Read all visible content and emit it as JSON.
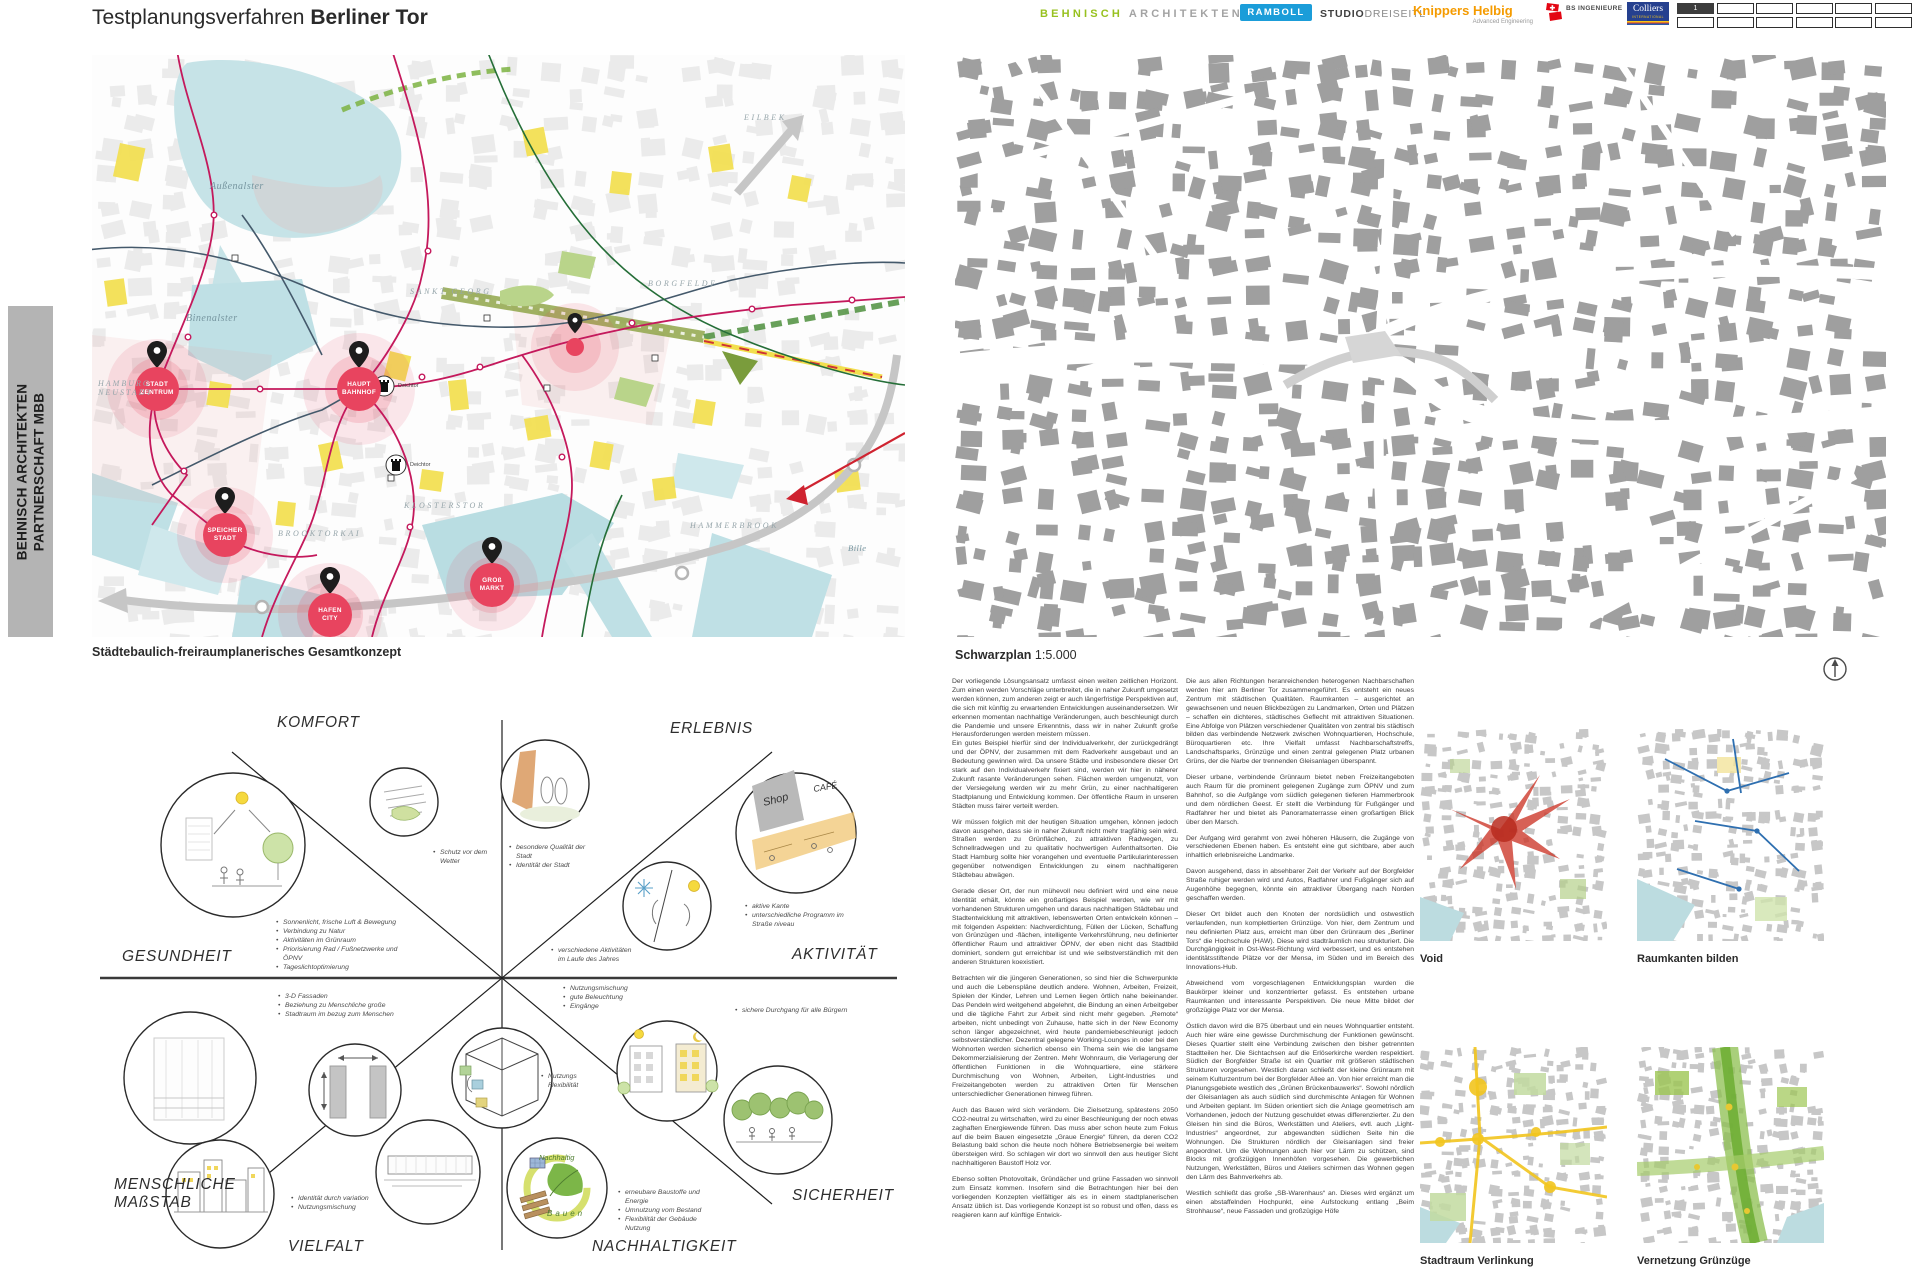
{
  "header": {
    "title_prefix": "Testplanungsverfahren",
    "title_bold": "Berliner Tor",
    "logos": {
      "behnisch_first": "BEHNISCH",
      "behnisch_second": "ARCHITEKTEN",
      "ramboll": "RAMBOLL",
      "studio_bold": "STUDIO",
      "studio_light": "DREISEITL",
      "knippers": "Knippers Helbig",
      "knippers_sub": "Advanced Engineering",
      "bs_name": "BS INGENIEURE",
      "colliers": "Colliers",
      "colliers_sub": "INTERNATIONAL",
      "sheet_number": "1"
    }
  },
  "side_band": {
    "text": "BEHNISCH ARCHITEKTEN\nPARTNERSCHAFT MBB"
  },
  "concept_map": {
    "caption": "Städtebaulich-freiraumplanerisches Gesamtkonzept",
    "markers": [
      {
        "label": "STADT\nZENTRUM"
      },
      {
        "label": "HAUPT\nBAHNHOF"
      },
      {
        "label": "SPEICHER\nSTADT"
      },
      {
        "label": "HAFEN\nCITY"
      },
      {
        "label": "GROß\nMARKT"
      }
    ],
    "labels": {
      "aussenalster": "Außenalster",
      "binnenalster": "Binenalster",
      "neustadt": "HAMBURG\nNEUSTADT",
      "sankt_georg": "SANKT GEORG",
      "eilbek": "EILBEK",
      "borgfelde": "BORGFELDE",
      "klostertor": "KLOSTERSTOR",
      "brooktorkai": "BROOKTORKAI",
      "hammerbrook": "HAMMERBROOK",
      "bille": "Bille",
      "deichtor": "Deichtor"
    }
  },
  "schwarzplan": {
    "caption_bold": "Schwarzplan",
    "caption_scale": "1:5.000"
  },
  "diagram": {
    "sectors": {
      "komfort": "KOMFORT",
      "erlebnis": "ERLEBNIS",
      "gesundheit": "GESUNDHEIT",
      "aktivitaet": "AKTIVITÄT",
      "massstab": "MENSCHLICHE\nMAßSTAB",
      "sicherheit": "SICHERHEIT",
      "vielfalt": "VIELFALT",
      "nachhaltigkeit": "NACHHALTIGKEIT"
    },
    "sketch_labels": {
      "shop": "Shop",
      "cafe": "CAFÉ",
      "nachhaltig": "Nachhaltig",
      "bauen": "Bauen"
    },
    "bullets": {
      "wetter": [
        "Schutz vor dem Wetter"
      ],
      "qualitaet": [
        "besondere Qualität der Stadt",
        "Identität der Stadt"
      ],
      "kante": [
        "aktive Kante",
        "unterschiedliche Programm im Straße niveau"
      ],
      "gesundheit": [
        "Sonnenlicht, frische Luft & Bewegung",
        "Verbindung zu Natur",
        "Aktivitäten im Grünraum",
        "Priorisierung Rad / Fußnetzwerke und ÖPNV",
        "Tageslichtoptimierung"
      ],
      "aktivitaeten": [
        "verschiedene Aktivitäten im Laufe des Jahres"
      ],
      "fassaden": [
        "3-D Fassaden",
        "Beziehung zu Menschliche große",
        "Stadtraum im bezug zum Menschen"
      ],
      "mischung": [
        "Nutzungsmischung",
        "gute Beleuchtung",
        "Eingänge"
      ],
      "durchgang": [
        "sichere Durchgang für alle Bürgern"
      ],
      "flexibilitaet": [
        "Nutzungs Flexibilität"
      ],
      "vielfalt_b": [
        "Identität durch variation",
        "Nutzungsmischung"
      ],
      "nachhaltig_b": [
        "erneubare Baustoffe und Energie",
        "Umnutzung vom Bestand",
        "Flexibilität der Gebäude Nutzung"
      ]
    }
  },
  "essay": {
    "col1": [
      "Der vorliegende Lösungsansatz umfasst einen weiten zeitlichen Horizont. Zum einen werden Vorschläge unterbreitet, die in naher Zukunft umgesetzt werden können, zum anderen zeigt er auch längerfristige Perspektiven auf, die sich mit künftig zu erwartenden Entwicklungen auseinandersetzen. Wir erkennen momentan nachhaltige Veränderungen, auch beschleunigt durch die Pandemie und unsere Erkenntnis, dass wir in naher Zukunft große Herausforderungen werden meistern müssen.\nEin gutes Beispiel hierfür sind der Individualverkehr, der zurückgedrängt und der ÖPNV, der zusammen mit dem Radverkehr ausgebaut und an Bedeutung gewinnen wird. Da unsere Städte und insbesondere dieser Ort stark auf den Individualverkehr fixiert sind, werden wir hier in näherer Zukunft rasante Veränderungen sehen. Flächen werden umgenutzt, von der Versiegelung werden wir zu mehr Grün, zu einer nachhaltigeren Stadtplanung und Entwicklung kommen. Der öffentliche Raum in unseren Städten muss fairer verteilt werden.",
      "Wir müssen folglich mit der heutigen Situation umgehen, können jedoch davon ausgehen, dass sie in naher Zukunft nicht mehr tragfähig sein wird. Straßen werden zu Grünflächen, zu attraktiven Radwegen, zu Schnellradwegen und zu qualitativ hochwertigen Aufenthaltsorten. Die Stadt Hamburg sollte hier vorangehen und eventuelle Partikularinteressen gegenüber notwendigen Entwicklungen zu einem nachhaltigeren Städtebau abwägen.",
      "Gerade dieser Ort, der nun mühevoll neu definiert wird und eine neue Identität erhält, könnte ein großartiges Beispiel werden, wie wir mit vorhandenen Strukturen umgehen und daraus nachhaltigen Städtebau und Stadtentwicklung mit attraktiven, lebenswerten Orten entwickeln können – mit folgenden Aspekten: Nachverdichtung, Füllen der Lücken, Schaffung von Grünzügen und -flächen, intelligente Verkehrsführung, neu definierter öffentlicher Raum und attraktiver ÖPNV, der eben nicht das Stadtbild dominiert, sondern gut erreichbar ist und wie selbstverständlich mit den anderen Strukturen koexistiert.",
      "Betrachten wir die jüngeren Generationen, so sind hier die Schwerpunkte und auch die Lebenspläne deutlich andere. Wohnen, Arbeiten, Freizeit, Spielen der Kinder, Lehren und Lernen liegen örtlich nahe beieinander. Das Pendeln wird weitgehend abgelehnt, die Bindung an einen Arbeitgeber und die tägliche Fahrt zur Arbeit sind nicht mehr gegeben. „Remote“ arbeiten, nicht unbedingt von Zuhause, hatte sich in der New Economy schon länger abgezeichnet, wird heute pandemiebeschleunigt jedoch selbstverständlicher. Dezentral gelegene Working-Lounges in oder bei den Wohnorten werden sicherlich ebenso ein Thema sein wie die langsame Dekommerzialisierung der Zentren. Mehr Wohnraum, die Verlagerung der öffentlichen Funktionen in die Wohnquartiere, eine stärkere Durchmischung von Wohnen, Arbeiten, Light-Industries und Freizeitangeboten werden zu attraktiven Orten für Menschen unterschiedlicher Generationen hinweg führen.",
      "Auch das Bauen wird sich verändern. Die Zielsetzung, spätestens 2050 CO2-neutral zu wirtschaften, wird zu einer Beschleunigung der noch etwas zaghaften Energiewende führen. Das muss aber schon heute zum Fokus auf die beim Bauen eingesetzte „Graue Energie“ führen, da deren CO2 Belastung bald schon die heute noch höhere Betriebsenergie bei weitem übersteigen wird. So schlagen wir dort wo sinnvoll den aus heutiger Sicht nachhaltigeren Baustoff Holz vor.",
      "Ebenso sollten Photovoltaik, Gründächer und grüne Fassaden wo sinnvoll zum Einsatz kommen. Insofern sind die Betrachtungen hier bei den vorliegenden Konzepten vielfältiger als es in einem stadtplanerischen Ansatz üblich ist. Das vorliegende Konzept ist so robust und offen, dass es reagieren kann auf künftige Entwick-"
    ],
    "col2": [
      "Die aus allen Richtungen heranreichenden heterogenen Nachbarschaften werden hier am Berliner Tor zusammengeführt. Es entsteht ein neues Zentrum mit städtischen Qualitäten. Raumkanten – ausgerichtet an gewachsenen und neuen Blickbezügen zu Landmarken, Orten und Plätzen – schaffen ein dichteres, städtisches Geflecht mit attraktiven Situationen. Eine Abfolge von Plätzen verschiedener Qualitäten von zentral bis städtisch bilden das verbindende Netzwerk zwischen Wohnquartieren, Hochschule, Büroquartieren etc. Ihre Vielfalt umfasst Nachbarschaftstreffs, Landschaftsparks, Grünzüge und einen zentral gelegenen Platz urbanen Grüns, der die Narbe der trennenden Gleisanlagen überspannt.",
      "Dieser urbane, verbindende Grünraum bietet neben Freizeitangeboten auch Raum für die prominent gelegenen Zugänge zum ÖPNV und zum Bahnhof, so die Aufgänge vom südlich gelegenen tieferen Hammerbrook und dem nördlichen Geest. Er stellt die Verbindung für Fußgänger und Radfahrer her und bietet als Panoramaterrasse einen großartigen Blick über den Marsch.",
      "Der Aufgang wird gerahmt von zwei höheren Häusern, die Zugänge von verschiedenen Ebenen haben. Es entsteht eine gut sichtbare, aber auch inhaltlich erlebnisreiche Landmarke.",
      "Davon ausgehend, dass in absehbarer Zeit der Verkehr auf der Borgfelder Straße ruhiger werden wird und Autos, Radfahrer und Fußgänger sich auf Augenhöhe begegnen, könnte ein attraktiver Übergang nach Norden geschaffen werden.",
      "Dieser Ort bildet auch den Knoten der nordsüdlich und ostwestlich verlaufenden, nun komplettierten Grünzüge. Von hier, dem Zentrum und neu definierten Platz aus, erreicht man über den Grünraum des „Berliner Tors“ die Hochschule (HAW). Diese wird stadträumlich neu strukturiert. Die Durchgängigkeit in Ost-West-Richtung wird verbessert, und es entstehen identitätsstiftende Plätze vor der Mensa, im Süden und im Bereich des Innovations-Hub.",
      "Abweichend vom vorgeschlagenen Entwicklungsplan wurden die Baukörper kleiner und konzentrierter gefasst. Es entstehen urbane Raumkanten und interessante Perspektiven. Die neue Mitte bildet der großzügige Platz vor der Mensa.",
      "Östlich davon wird die B75 überbaut und ein neues Wohnquartier entsteht. Auch hier wäre eine gewisse Durchmischung der Funktionen gewünscht. Dieses Quartier stellt eine Verbindung zwischen den bisher getrennten Stadtteilen her. Die Sichtachsen auf die Erlöserkirche werden respektiert. Südlich der Borgfelder Straße ist ein Quartier mit größeren städtischen Strukturen vorgesehen. Westlich daran schließt der kleine Grünraum mit seinem Kulturzentrum bei der Borgfelder Allee an. Von hier erreicht man die Planungsgebiete westlich des „Grünen Brückenbauwerks“. Sowohl nördlich der Gleisanlagen als auch südlich sind durchmischte Anlagen für Wohnen und Arbeiten geplant. Im Süden orientiert sich die Anlage geometrisch am Vorhandenen, jedoch der Nutzung geschuldet etwas differenzierter. Zu den Gleisen hin sind die Büros, Werkstätten und Ateliers, evtl. auch „Light-Industries“ angeordnet, zur abgewandten südlichen Seite hin die Wohnungen. Die Strukturen nördlich der Gleisanlagen sind freier angeordnet. Um die Wohnungen auch hier vor Lärm zu schützen, sind Blocks mit großzügigen Innenhöfen vorgesehen. Die gewerblichen Nutzungen, Werkstätten, Büros und Ateliers schirmen das Wohnen gegen den Lärm des Bahnverkehrs ab.",
      "Westlich schließt das große „SB-Warenhaus“ an. Dieses wird ergänzt um einen abstaffelnden Hochpunkt, eine Aufstockung entlang „Beim Strohhause“, neue Fassaden und großzügige Höfe"
    ]
  },
  "minimaps": [
    {
      "caption": "Void"
    },
    {
      "caption": "Raumkanten bilden"
    },
    {
      "caption": "Stadtraum Verlinkung"
    },
    {
      "caption": "Vernetzung Grünzüge"
    }
  ],
  "colors": {
    "behnisch_green": "#97c11f",
    "ramboll_blue": "#1b9dd9",
    "knippers_orange": "#f59b00",
    "bs_red": "#e30613",
    "colliers_navy": "#25408f",
    "marker_red": "#e8445f",
    "transit_crimson": "#c4195c",
    "water_teal": "#c8e4e8",
    "accent_yellow": "#f2df4e",
    "green": "#7cb342",
    "building_gray": "#9f9f9f"
  }
}
